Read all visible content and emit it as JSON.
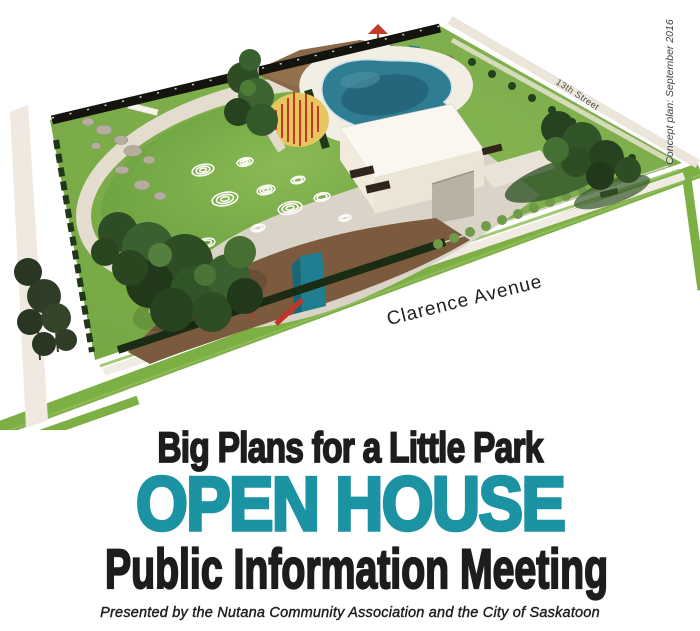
{
  "poster": {
    "headline": "Big Plans for a Little Park",
    "open_house_title": "OPEN HOUSE",
    "subtitle": "Public Information Meeting",
    "presented_by": "Presented by the Nutana Community Association and the City of Saskatoon"
  },
  "park_plan": {
    "caption_vertical": "Concept plan: September 2016",
    "street_bottom": "Clarence Avenue",
    "street_right": "13th Street"
  },
  "colors": {
    "accent_teal": "#1b93a3",
    "text_black": "#1d1d1b"
  }
}
